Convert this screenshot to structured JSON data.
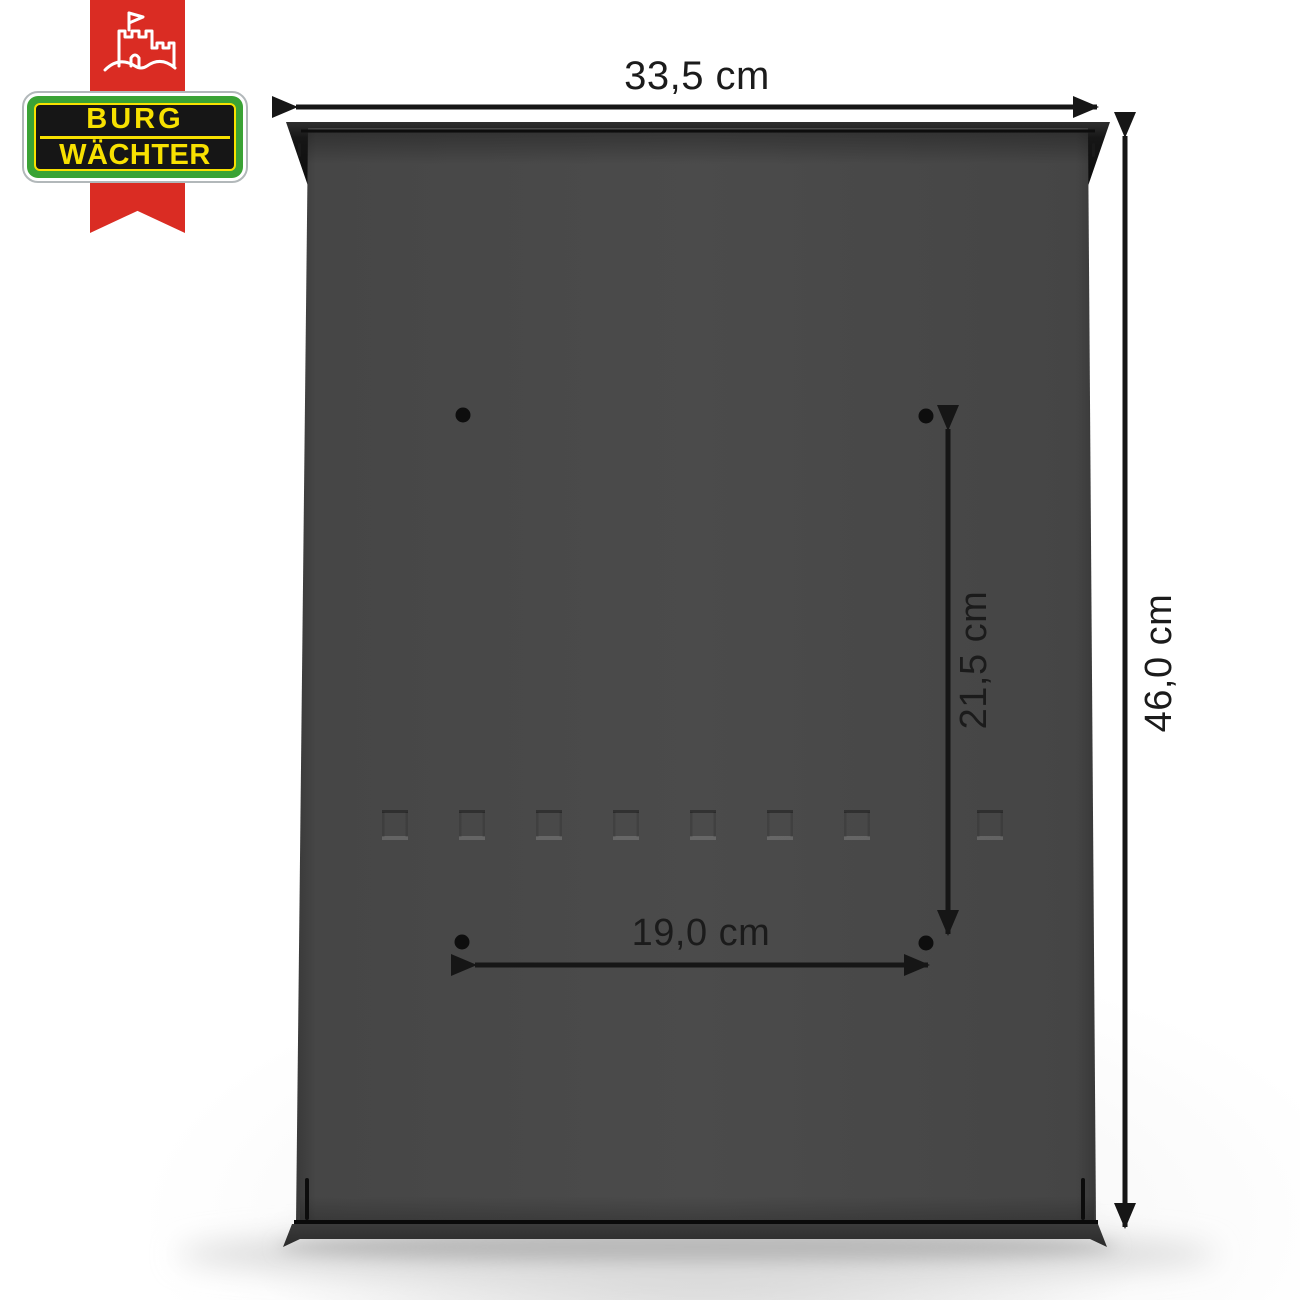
{
  "brand": {
    "line1": "BURG",
    "line2": "WÄCHTER",
    "colors": {
      "ribbon_red": "#da2c23",
      "frame_green": "#3aa335",
      "accent_yellow": "#f8e100",
      "panel_black": "#161616"
    }
  },
  "product": {
    "body_color": "#4a4a4a",
    "mounting_hole_count": 4
  },
  "dimensions": {
    "overall_width": "33,5 cm",
    "overall_height": "46,0 cm",
    "hole_spacing_vertical": "21,5 cm",
    "hole_spacing_horizontal": "19,0 cm"
  }
}
